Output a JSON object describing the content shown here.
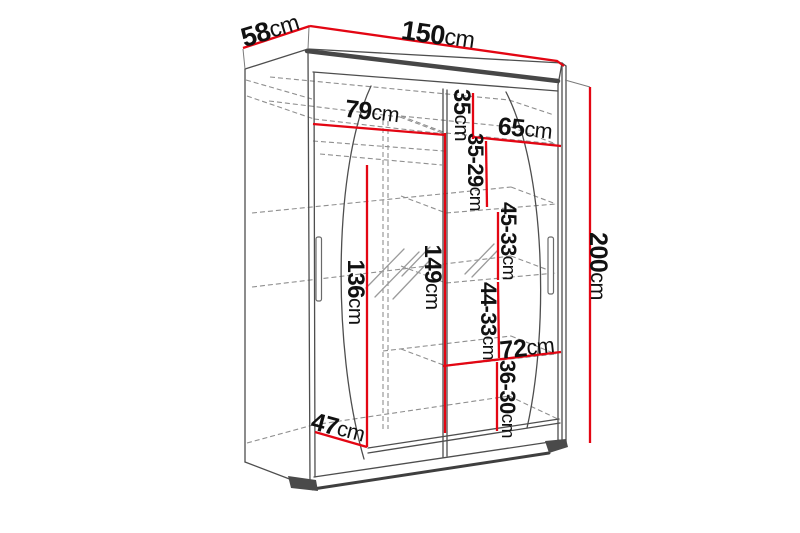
{
  "diagram": {
    "kind": "wardrobe-dimension-drawing",
    "background": "#ffffff",
    "colors": {
      "dimension_line": "#e30613",
      "outline": "#4e4e4e",
      "hidden_line": "#8f8f8f",
      "label_text": "#111111"
    },
    "dimensions": {
      "depth": {
        "value": "58",
        "unit": "cm"
      },
      "width": {
        "value": "150",
        "unit": "cm"
      },
      "height": {
        "value": "200",
        "unit": "cm"
      },
      "left_section_width": {
        "value": "79",
        "unit": "cm"
      },
      "top_shelf_height": {
        "value": "35",
        "unit": "cm"
      },
      "right_section_width": {
        "value": "65",
        "unit": "cm"
      },
      "right_gap_1": {
        "value": "35-29",
        "unit": "cm"
      },
      "right_gap_2": {
        "value": "45-33",
        "unit": "cm"
      },
      "hanging_height": {
        "value": "136",
        "unit": "cm"
      },
      "interior_height": {
        "value": "149",
        "unit": "cm"
      },
      "right_gap_3": {
        "value": "44-33",
        "unit": "cm"
      },
      "bottom_shelf_width": {
        "value": "72",
        "unit": "cm"
      },
      "right_gap_4": {
        "value": "36-30",
        "unit": "cm"
      },
      "usable_depth": {
        "value": "47",
        "unit": "cm"
      }
    }
  }
}
